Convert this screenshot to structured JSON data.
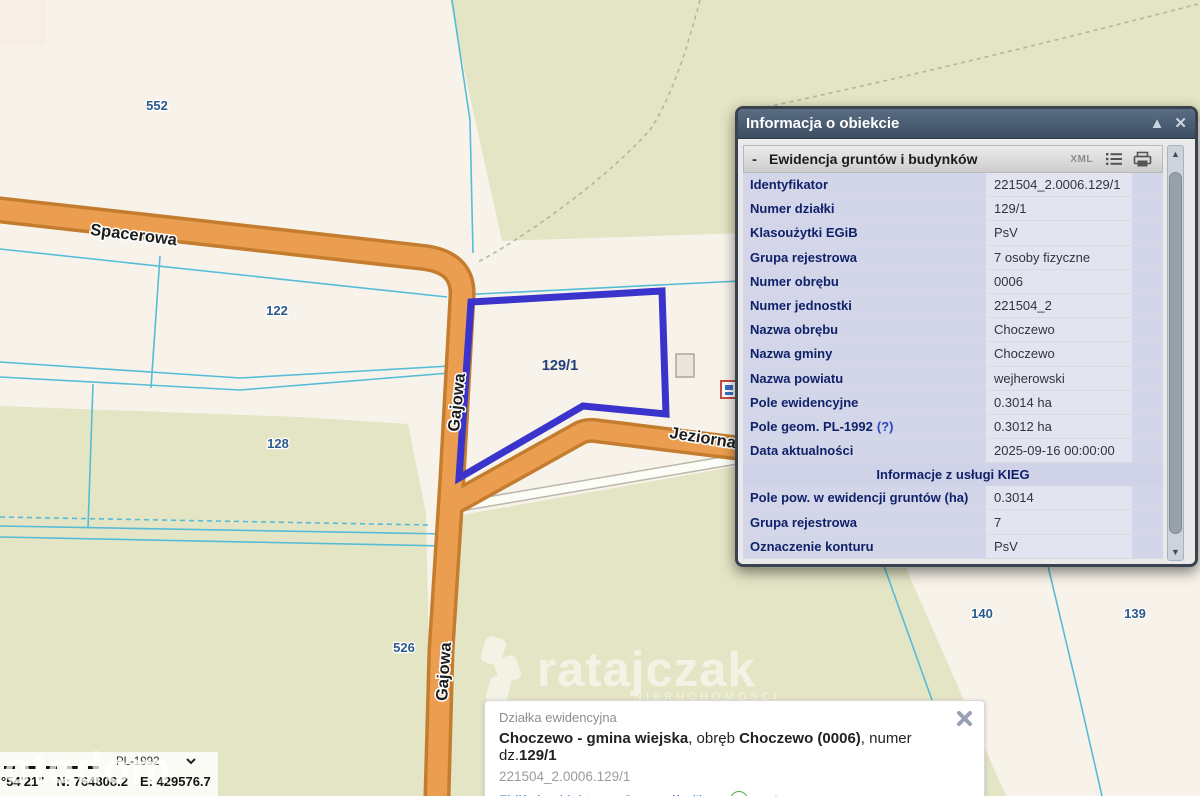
{
  "map": {
    "parcel_labels": [
      {
        "text": "552"
      },
      {
        "text": "122"
      },
      {
        "text": "128"
      },
      {
        "text": "526"
      },
      {
        "text": "140"
      },
      {
        "text": "139"
      }
    ],
    "highlighted_parcel_label": "129/1",
    "street_labels": [
      {
        "text": "Spacerowa"
      },
      {
        "text": "Gajowa"
      },
      {
        "text": "Gajowa"
      },
      {
        "text": "Jeziorna"
      }
    ],
    "colors": {
      "base": "#f8f3ea",
      "meadow": "#e4e5c5",
      "road_fill": "#eb9e50",
      "road_casing": "#c47d2e",
      "boundary_line": "#55bcd8",
      "highlight_outline": "#3a33cc",
      "label_blue": "#2b5a8c"
    }
  },
  "info_panel": {
    "title": "Informacja o obiekcie",
    "minimize_icon": "▲",
    "close_icon": "✕",
    "section": {
      "collapse": "-",
      "title": "Ewidencja gruntów i budynków",
      "xml_label": "XML"
    },
    "rows": [
      {
        "label": "Identyfikator",
        "value": "221504_2.0006.129/1"
      },
      {
        "label": "Numer działki",
        "value": "129/1"
      },
      {
        "label": "Klasoużytki EGiB",
        "value": "PsV"
      },
      {
        "label": "Grupa rejestrowa",
        "value": "7 osoby fizyczne"
      },
      {
        "label": "Numer obrębu",
        "value": "0006"
      },
      {
        "label": "Numer jednostki",
        "value": "221504_2"
      },
      {
        "label": "Nazwa obrębu",
        "value": "Choczewo"
      },
      {
        "label": "Nazwa gminy",
        "value": "Choczewo"
      },
      {
        "label": "Nazwa powiatu",
        "value": "wejherowski"
      },
      {
        "label": "Pole ewidencyjne",
        "value": "0.3014 ha"
      },
      {
        "label": "Pole geom. PL-1992",
        "link": "(?)",
        "value": "0.3012 ha"
      },
      {
        "label": "Data aktualności",
        "value": "2025-09-16 00:00:00"
      },
      {
        "label": "Pole pow. w ewidencji gruntów (ha)",
        "value": "0.3014"
      },
      {
        "label": "Grupa rejestrowa",
        "value": "7"
      },
      {
        "label": "Oznaczenie konturu",
        "value": "PsV"
      }
    ],
    "subheader": "Informacje z usługi KIEG"
  },
  "feature_card": {
    "type_label": "Działka ewidencyjna",
    "title_parts": [
      {
        "text": "Choczewo - gmina wiejska"
      },
      {
        "text": ", obręb "
      },
      {
        "text": "Choczewo (0006)"
      },
      {
        "text": ", numer dz."
      },
      {
        "text": "129/1"
      }
    ],
    "identifier": "221504_2.0006.129/1",
    "links": [
      {
        "label": "Zbliż do obiektu"
      },
      {
        "label": "Szczegóły (I)"
      },
      {
        "label": "Inne"
      }
    ],
    "plus_glyph": "+"
  },
  "status_bar": {
    "crs": "PL-1992",
    "coord_fragment": "°54'21\"",
    "north": "N: 764808.2",
    "east": "E: 429576.7"
  },
  "watermarks": {
    "center_logo": "ratajczak",
    "center_sub": "NIERUCHOMOŚCI",
    "corner": "otodom"
  }
}
